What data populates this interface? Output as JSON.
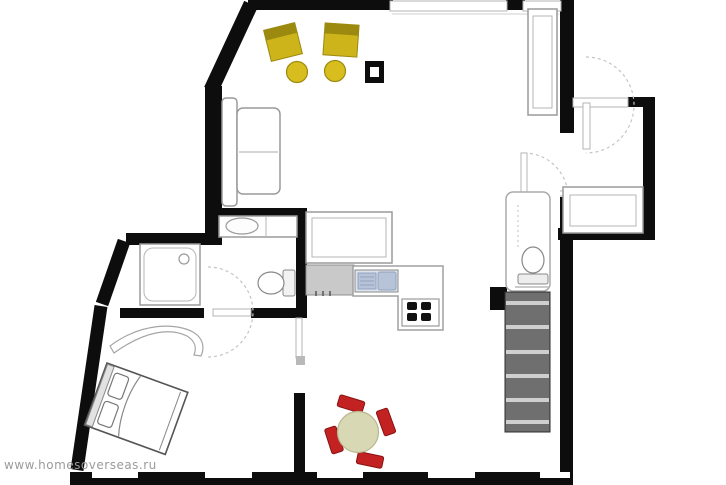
{
  "meta": {
    "kind": "apartment-floor-plan",
    "width": 726,
    "height": 485
  },
  "watermark": {
    "text": "www.homesoverseas.ru"
  },
  "palette": {
    "paper": "#ffffff",
    "wall": "#0d0d0d",
    "outline": "#9a9a9a",
    "outline-light": "#b5b5b5",
    "dash": "#c4c4c4",
    "seat": "#cdb41a",
    "seat-dark": "#9c8a10",
    "pouf": "#d8bd1e",
    "red": "#c32222",
    "red-dark": "#891111",
    "tabletop": "#d9d8b4",
    "counter": "#c9c9c9",
    "sink": "#b7c3d6",
    "sink-line": "#92a3c0",
    "stairs": "#6f6f6f",
    "tread": "#cfcfcf",
    "watermark": "#9b9b9b"
  },
  "legend": {
    "living-area": [
      "armchair",
      "armchair",
      "pouf",
      "pouf",
      "sofa",
      "tall-cabinet",
      "column"
    ],
    "kitchen": [
      "island-table",
      "worktop",
      "double-sink",
      "stove-4-burners"
    ],
    "dining": [
      "round-table",
      "chair",
      "chair",
      "chair",
      "chair"
    ],
    "bathroom": [
      "vanity-sink",
      "toilet",
      "shower-cabin"
    ],
    "bedroom": [
      "double-bed",
      "curved-shelf"
    ],
    "wc": [
      "toilet"
    ],
    "entry-hall": [
      "desk"
    ],
    "circulation": [
      "staircase"
    ],
    "openings": [
      "entry-door",
      "bathroom-door",
      "hall-door",
      "wc-door",
      "passage-door"
    ],
    "windows": [
      "top-window",
      "top-window",
      "bottom-window",
      "bottom-window",
      "bottom-window",
      "bottom-window",
      "bottom-window"
    ]
  }
}
